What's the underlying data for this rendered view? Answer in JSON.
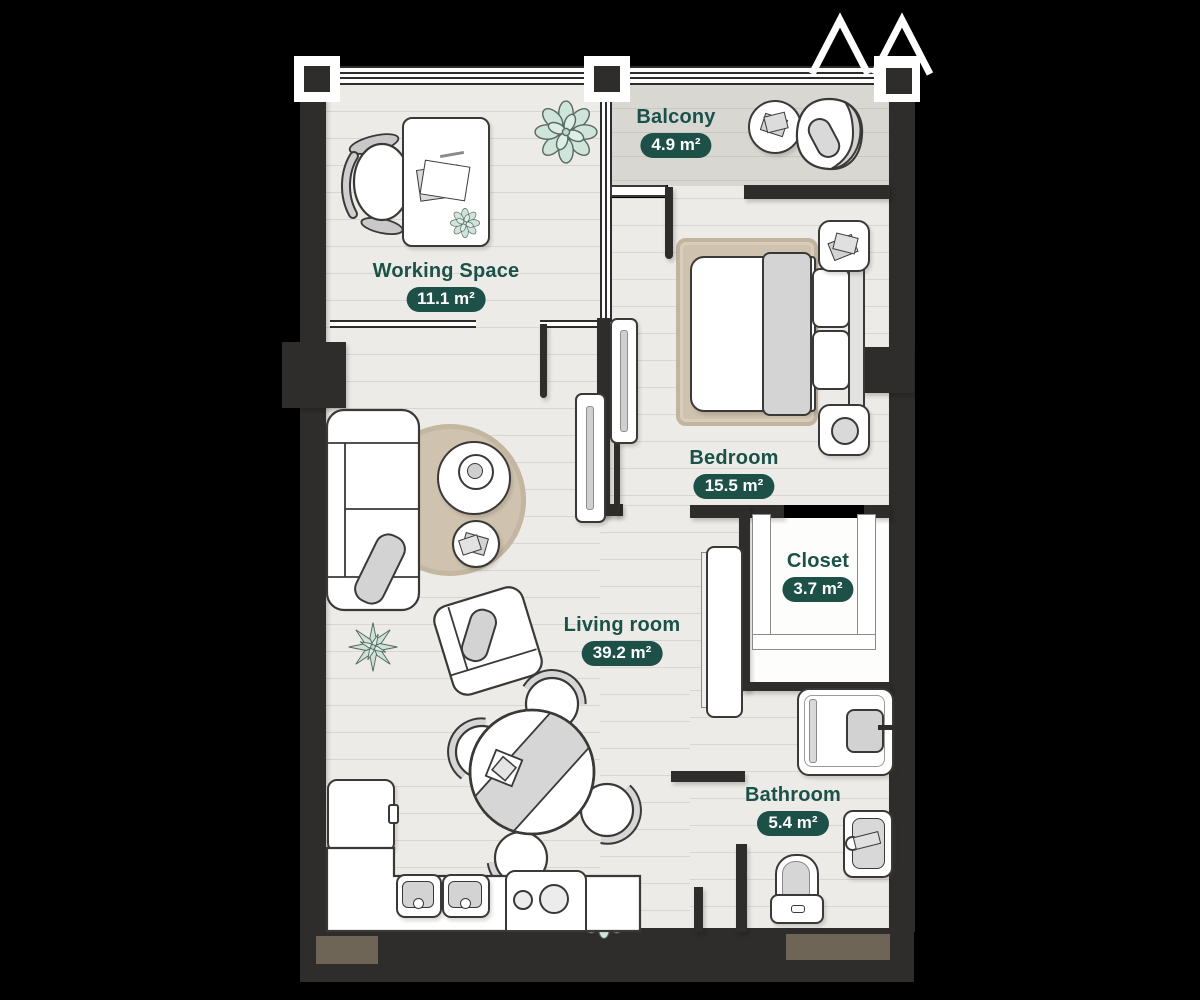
{
  "plan": {
    "type": "apartment-floor-plan",
    "rooms": [
      {
        "id": "balcony",
        "label": "Balcony",
        "area": "4.9 m²"
      },
      {
        "id": "working-space",
        "label": "Working Space",
        "area": "11.1 m²"
      },
      {
        "id": "bedroom",
        "label": "Bedroom",
        "area": "15.5 m²"
      },
      {
        "id": "closet",
        "label": "Closet",
        "area": "3.7 m²"
      },
      {
        "id": "living-room",
        "label": "Living room",
        "area": "39.2 m²"
      },
      {
        "id": "bathroom",
        "label": "Bathroom",
        "area": "5.4 m²"
      }
    ],
    "colors": {
      "background": "#000000",
      "wall": "#2e2d2b",
      "floor": "#edebe7",
      "balcony_floor": "#d9d7d2",
      "closet_floor": "#fdfdfc",
      "label_green": "#1a5148",
      "badge_bg": "#1d5047",
      "badge_text": "#ffffff",
      "furniture_fill": "#ffffff",
      "furniture_outline": "#3a3937",
      "cushion_gray": "#d3d3d3",
      "rug_tan": "#cfc3af",
      "plant_mint": "#cfe4da",
      "door_mat_brown": "#6f6557"
    },
    "furniture": [
      "balcony-table",
      "balcony-lounge-chair",
      "desk",
      "office-chair",
      "desk-plant",
      "plant-large",
      "sofa",
      "throw-pillow",
      "round-rug",
      "coffee-table",
      "side-table",
      "armchair",
      "floor-plant-star",
      "dining-table",
      "table-runner",
      "dining-chairs",
      "kitchen-counter",
      "kitchen-sinks",
      "stove",
      "fridge",
      "kitchen-plant",
      "bed",
      "blanket",
      "pillows",
      "headboard",
      "nightstands",
      "bedside-lamp",
      "bedroom-rug",
      "wardrobe",
      "tv-console",
      "shower",
      "bathroom-sink",
      "toilet",
      "sliding-doors",
      "door-mats",
      "zigzag-marker"
    ]
  }
}
